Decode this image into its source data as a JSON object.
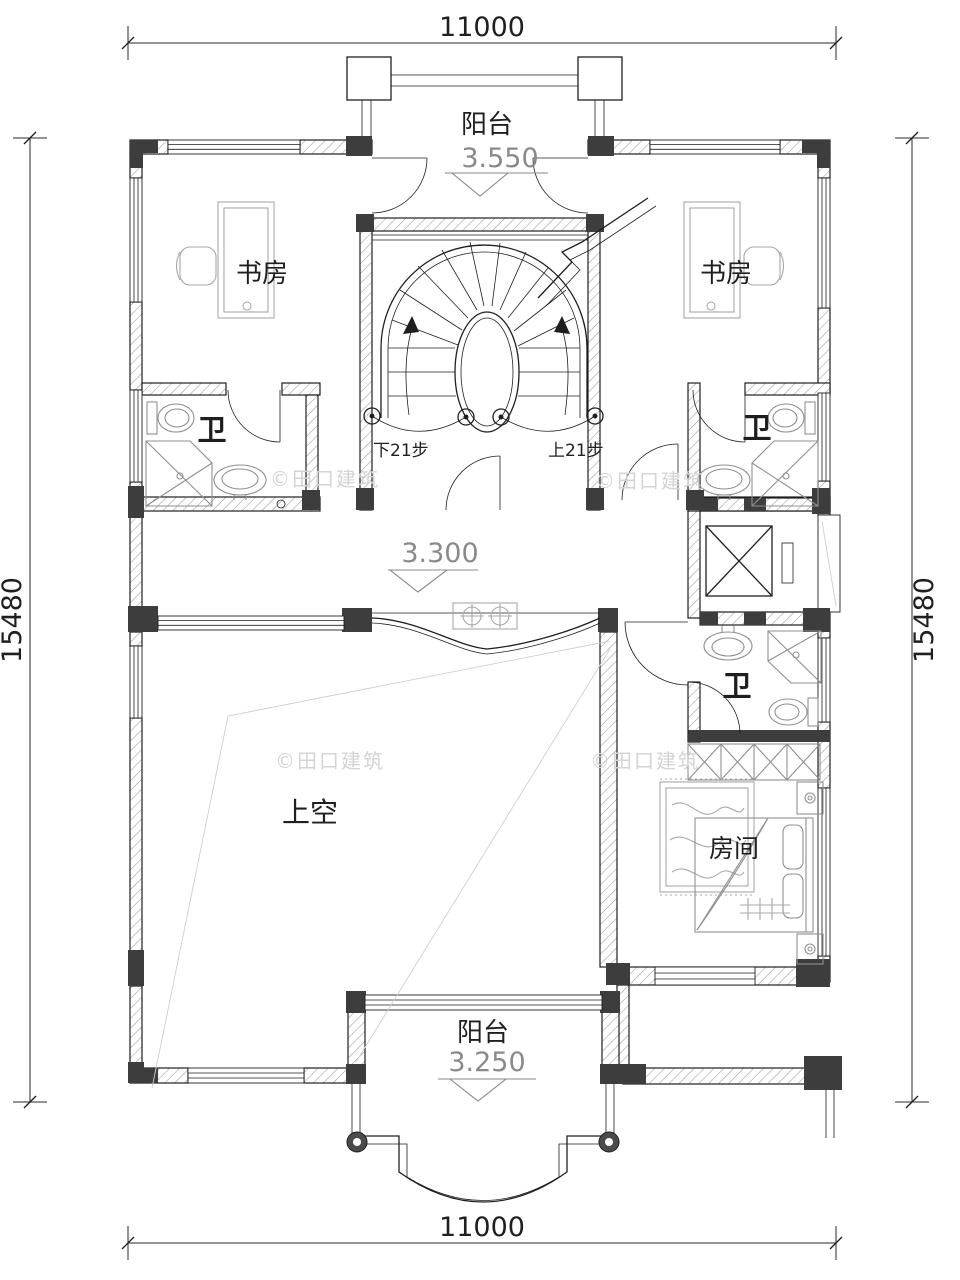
{
  "dimensions": {
    "top": "11000",
    "bottom": "11000",
    "left": "15480",
    "right": "15480"
  },
  "levels": {
    "balcony_top": "3.550",
    "corridor": "3.300",
    "balcony_bottom": "3.250"
  },
  "rooms": {
    "balcony_top": "阳台",
    "study_left": "书房",
    "study_right": "书房",
    "bath_left": "卫",
    "bath_right": "卫",
    "bath_lower": "卫",
    "void": "上空",
    "bedroom": "房间",
    "balcony_bottom": "阳台"
  },
  "stairs": {
    "down_label": "下21步",
    "up_label": "上21步"
  },
  "watermark": {
    "text": "©田口建筑"
  },
  "colors": {
    "line": "#1f1f1f",
    "column": "#3d3d3d",
    "hatch": "#9a9a9a",
    "fixture": "#8f8f8f",
    "furniture": "#a8a8a8",
    "level_text": "#8a8a8a",
    "watermark": "#d4d4d4",
    "background": "#ffffff"
  }
}
